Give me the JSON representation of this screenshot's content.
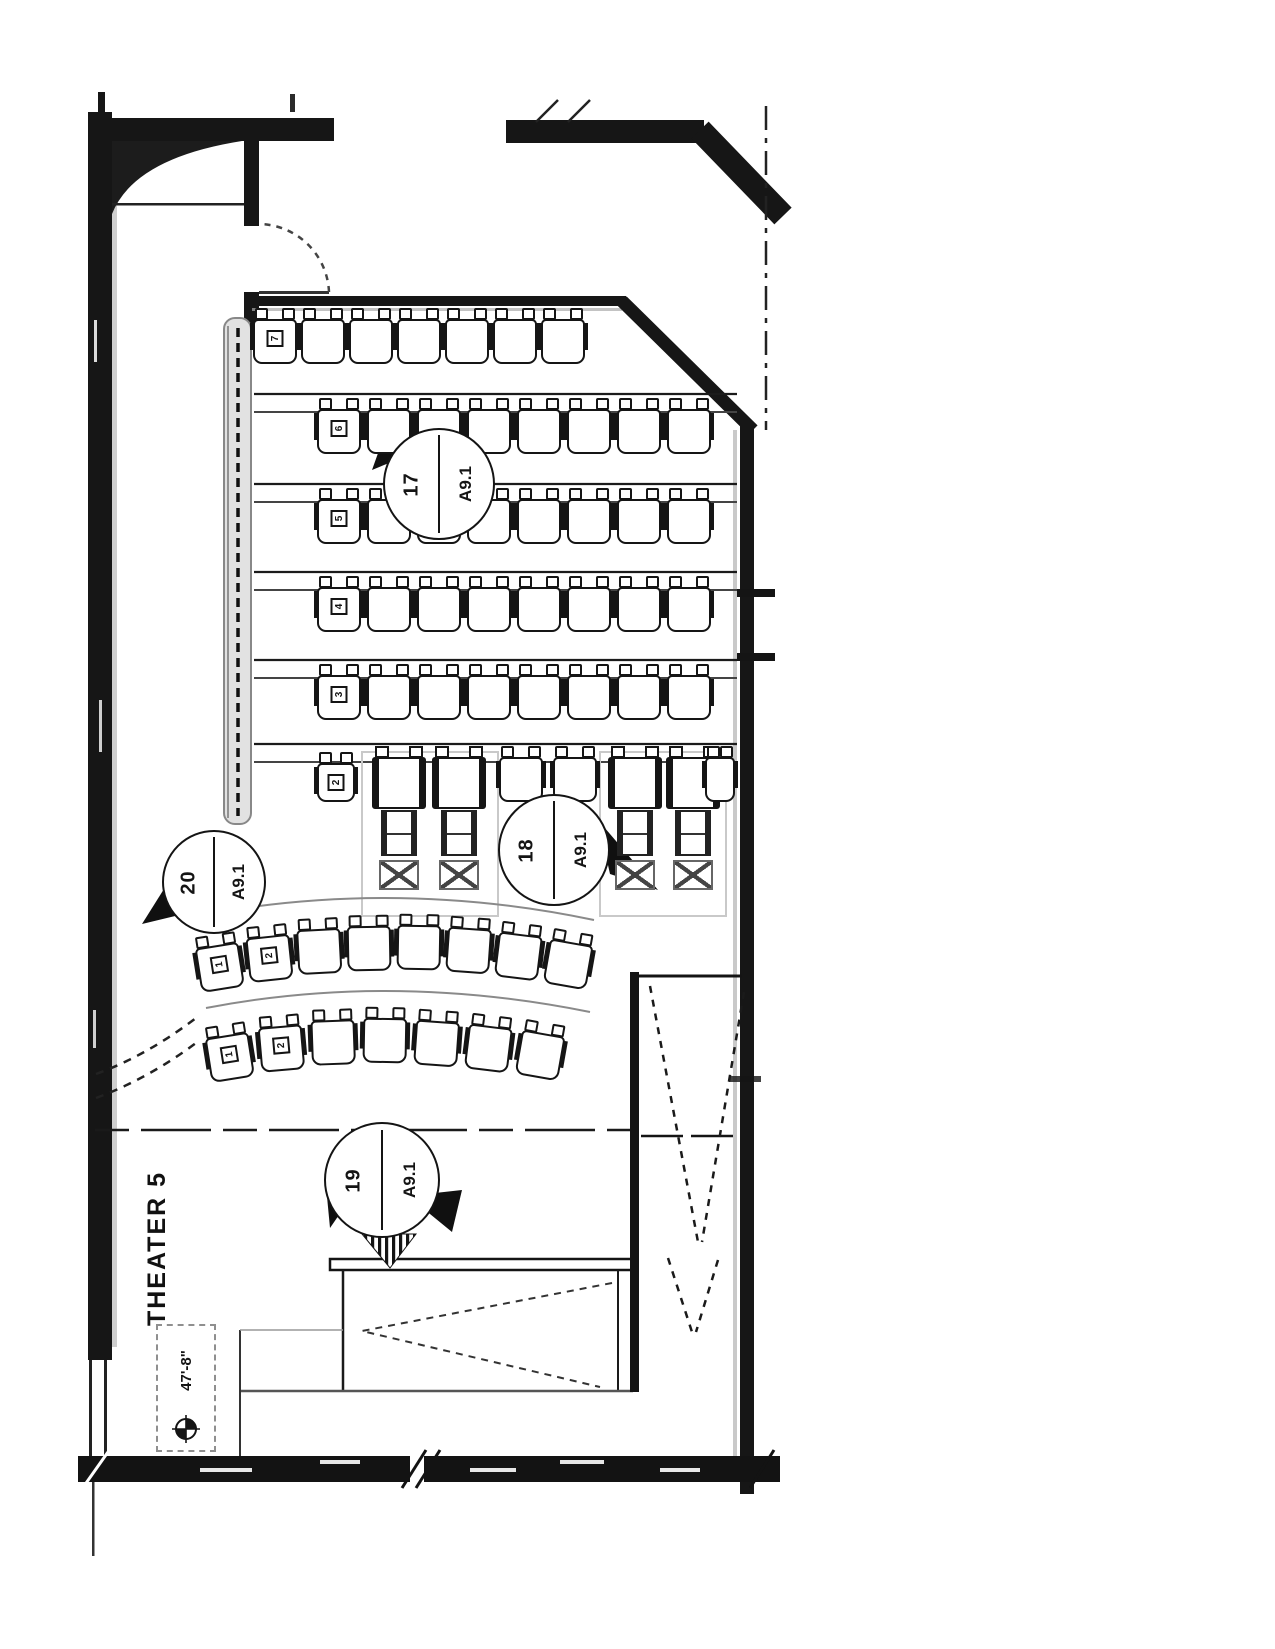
{
  "sheet": {
    "room_label": "THEATER 5",
    "stage_dimension": "47'-8\"",
    "callouts": [
      {
        "number": "17",
        "sheet": "A9.1"
      },
      {
        "number": "18",
        "sheet": "A9.1"
      },
      {
        "number": "19",
        "sheet": "A9.1"
      },
      {
        "number": "20",
        "sheet": "A9.1"
      }
    ],
    "seating": {
      "straight_rows": [
        {
          "label": "7",
          "seats": 7
        },
        {
          "label": "6",
          "seats": 8
        },
        {
          "label": "5",
          "seats": 8
        },
        {
          "label": "4",
          "seats": 8
        },
        {
          "label": "3",
          "seats": 8
        }
      ],
      "accessible_row": {
        "label": "2",
        "standard_seats": 4,
        "recliner_seats": 4
      },
      "curved_rows": [
        {
          "labels": [
            "1",
            "2"
          ],
          "seats": 8
        },
        {
          "labels": [
            "1",
            "2"
          ],
          "seats": 7
        }
      ]
    },
    "colors": {
      "ink": "#141414",
      "gray": "#9a9a9a",
      "paper": "#ffffff"
    }
  }
}
